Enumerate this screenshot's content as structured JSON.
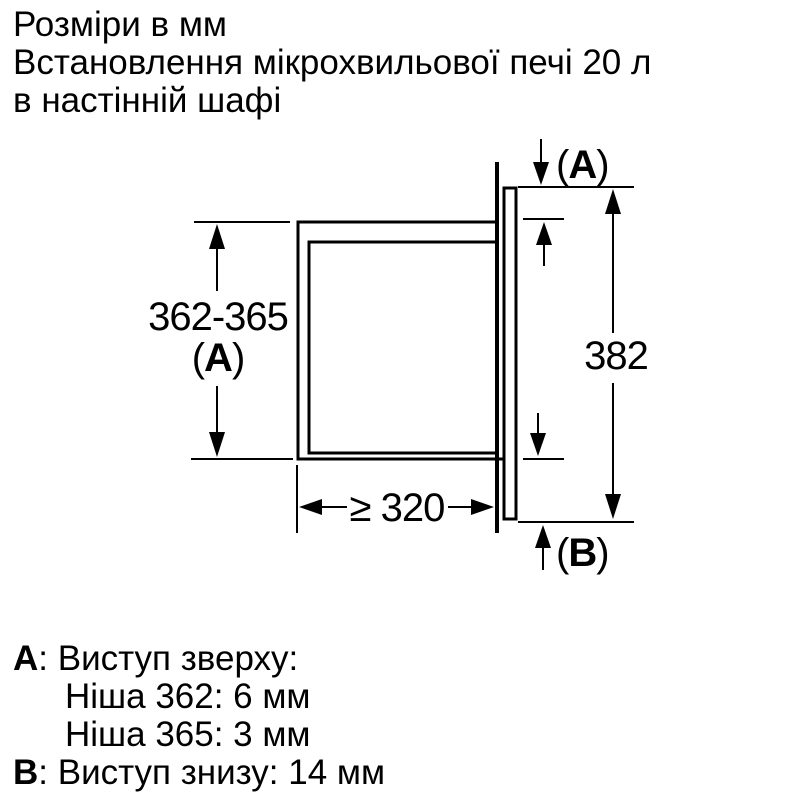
{
  "title": {
    "lines": [
      "Розміри в мм",
      "Встановлення мікрохвильової печі 20 л",
      "в настінній шафі"
    ]
  },
  "diagram": {
    "colors": {
      "line": "#000000",
      "background": "#ffffff"
    },
    "dimensions": {
      "top_protrusion": {
        "open": "(",
        "letter": "A",
        "close": ")"
      },
      "niche_height": {
        "value": "362-365",
        "ref_open": "(",
        "ref_letter": "A",
        "ref_close": ")"
      },
      "appliance_height": {
        "value": "382"
      },
      "niche_depth": {
        "value": "≥ 320"
      },
      "bottom_protrusion": {
        "open": "(",
        "letter": "B",
        "close": ")"
      }
    }
  },
  "legend": {
    "items": [
      {
        "key": "A",
        "text": ": Виступ зверху:"
      },
      {
        "key": "",
        "text": "Ніша 362: 6 мм"
      },
      {
        "key": "",
        "text": "Ніша 365: 3 мм"
      },
      {
        "key": "B",
        "text": ": Виступ знизу: 14 мм"
      }
    ]
  }
}
